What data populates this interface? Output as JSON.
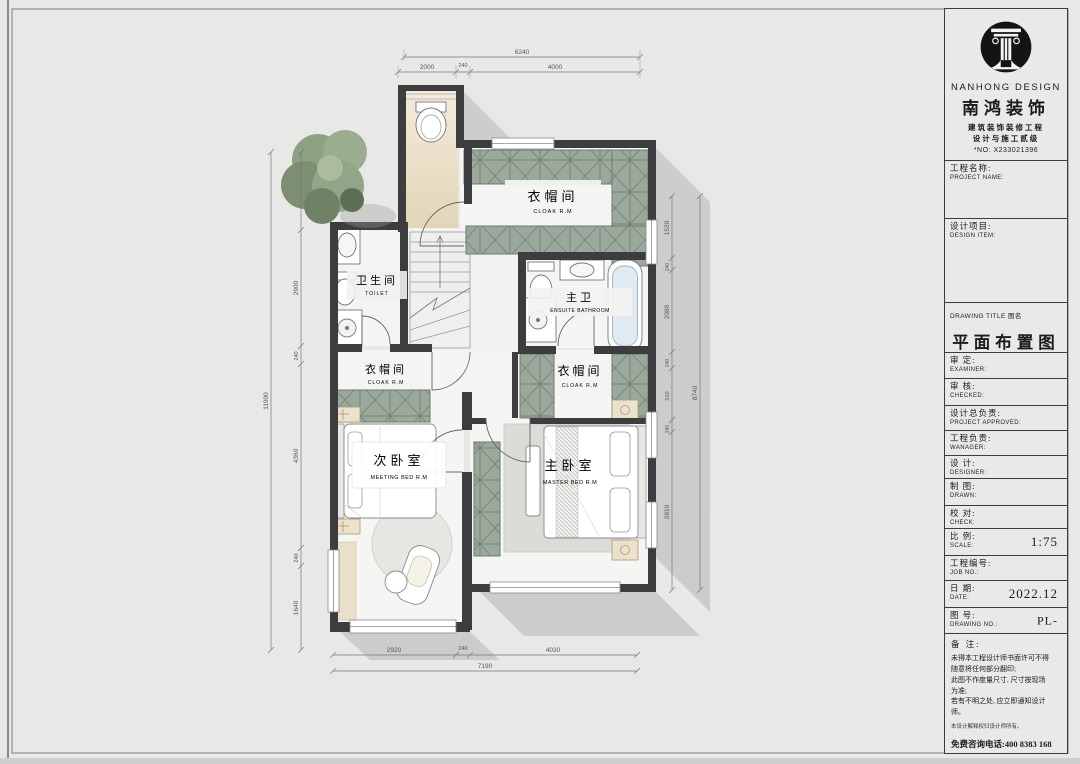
{
  "title_block": {
    "brand_en": "NANHONG DESIGN",
    "brand_cn": "南鸿装饰",
    "cert_line1": "建筑装饰装修工程",
    "cert_line2": "设计与施工贰级",
    "cert_no": "*NO: X233021396",
    "fields": [
      {
        "cn": "工程名称:",
        "en": "PROJECT NAME:",
        "value": ""
      },
      {
        "cn": "设计项目:",
        "en": "DESIGN ITEM:",
        "value": ""
      },
      {
        "cn": "审  定:",
        "en": "EXAMINER:",
        "value": ""
      },
      {
        "cn": "审  核:",
        "en": "CHECKED:",
        "value": ""
      },
      {
        "cn": "设计总负责:",
        "en": "PROJECT APPROVED:",
        "value": ""
      },
      {
        "cn": "工程负责:",
        "en": "WANAGER:",
        "value": ""
      },
      {
        "cn": "设  计:",
        "en": "DESIGNER:",
        "value": ""
      },
      {
        "cn": "制  图:",
        "en": "DRAWN:",
        "value": ""
      },
      {
        "cn": "校  对:",
        "en": "CHECK:",
        "value": ""
      },
      {
        "cn": "比  例:",
        "en": "SCALE:",
        "value": "1:75"
      },
      {
        "cn": "工程编号:",
        "en": "JOB NO.:",
        "value": ""
      },
      {
        "cn": "日  期:",
        "en": "DATE:",
        "value": "2022.12"
      },
      {
        "cn": "图  号:",
        "en": "DRAWING NO.:",
        "value": "PL-"
      }
    ],
    "drawing_title_label": "DRAWING TITLE 图名",
    "drawing_title": "平面布置图",
    "notes_label": "备  注:",
    "notes": [
      "未得本工程设计师书面许可不得",
      "随意将任何部分翻印;",
      "此图不作度量尺寸, 尺寸按现场",
      "为准;",
      "若有不明之处, 应立即通知设计",
      "师。"
    ],
    "notes_fine": "本设计解释权归设计师所有。",
    "hotline": "免费咨询电话:400 8383 168"
  },
  "plan": {
    "rooms": {
      "cloak_top": {
        "cn": "衣帽间",
        "en": "CLOAK R.M"
      },
      "toilet": {
        "cn": "卫生间",
        "en": "TOILET"
      },
      "ensuite": {
        "cn": "主卫",
        "en": "ENSUITE BATHROOM"
      },
      "cloak_left": {
        "cn": "衣帽间",
        "en": "CLOAK R.M"
      },
      "cloak_right": {
        "cn": "衣帽间",
        "en": "CLOAK R.M"
      },
      "bedroom2": {
        "cn": "次卧室",
        "en": "MEETING BED R.M"
      },
      "master": {
        "cn": "主卧室",
        "en": "MASTER BED R.M"
      }
    },
    "dims": {
      "top": {
        "total": "6240",
        "seg1": "2000",
        "seg2": "240",
        "seg3": "4000"
      },
      "bottom": {
        "total": "7190",
        "seg1": "2920",
        "seg2": "240",
        "seg3": "4030"
      },
      "left": {
        "total": "11900",
        "seg1": "2900",
        "seg2": "240",
        "seg3": "4360",
        "seg4": "240",
        "seg5": "1640"
      },
      "right": {
        "total": "8740",
        "seg1": "1520",
        "seg2": "240",
        "seg3": "2080",
        "seg4": "240",
        "seg5": "510",
        "seg6": "240",
        "seg7": "2810"
      }
    },
    "colors": {
      "wall": "#3d3d3f",
      "cabinet": "#9aa99c",
      "wood": "#e9ddc5",
      "accent_tree": "#8ea183"
    }
  }
}
